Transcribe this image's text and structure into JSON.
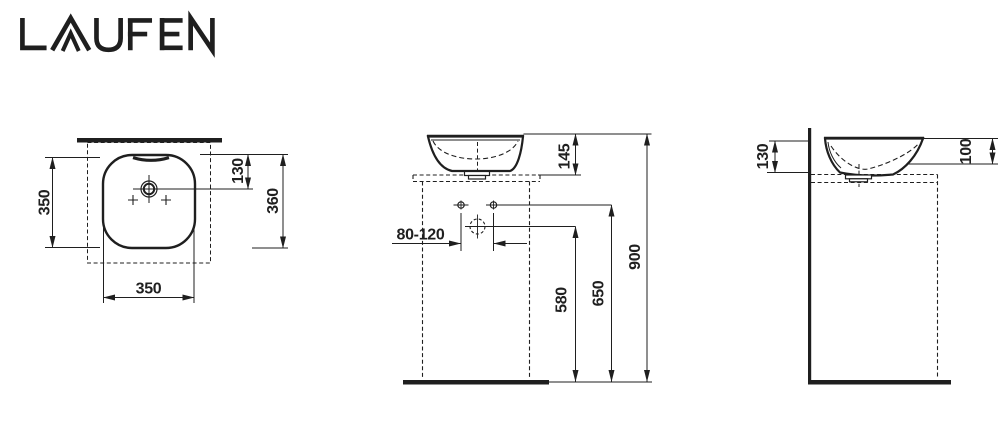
{
  "brand": {
    "logo_text": "LAUFEN"
  },
  "colors": {
    "ink": "#1f1f1f",
    "background": "#ffffff"
  },
  "drawing": {
    "type": "technical-dimension-drawing",
    "views": {
      "top_view": {
        "dims": {
          "depth_outer": "350",
          "drain_from_back": "130",
          "depth_with_wall": "360",
          "width": "350"
        }
      },
      "front_view": {
        "dims": {
          "bowl_height_above_counter": "145",
          "tap_hole_range": "80-120",
          "drain_height": "580",
          "fixing_height": "650",
          "rim_height": "900"
        }
      },
      "side_view": {
        "dims": {
          "rim_above_counter_back": "130",
          "rim_above_counter_front": "100"
        }
      }
    }
  }
}
